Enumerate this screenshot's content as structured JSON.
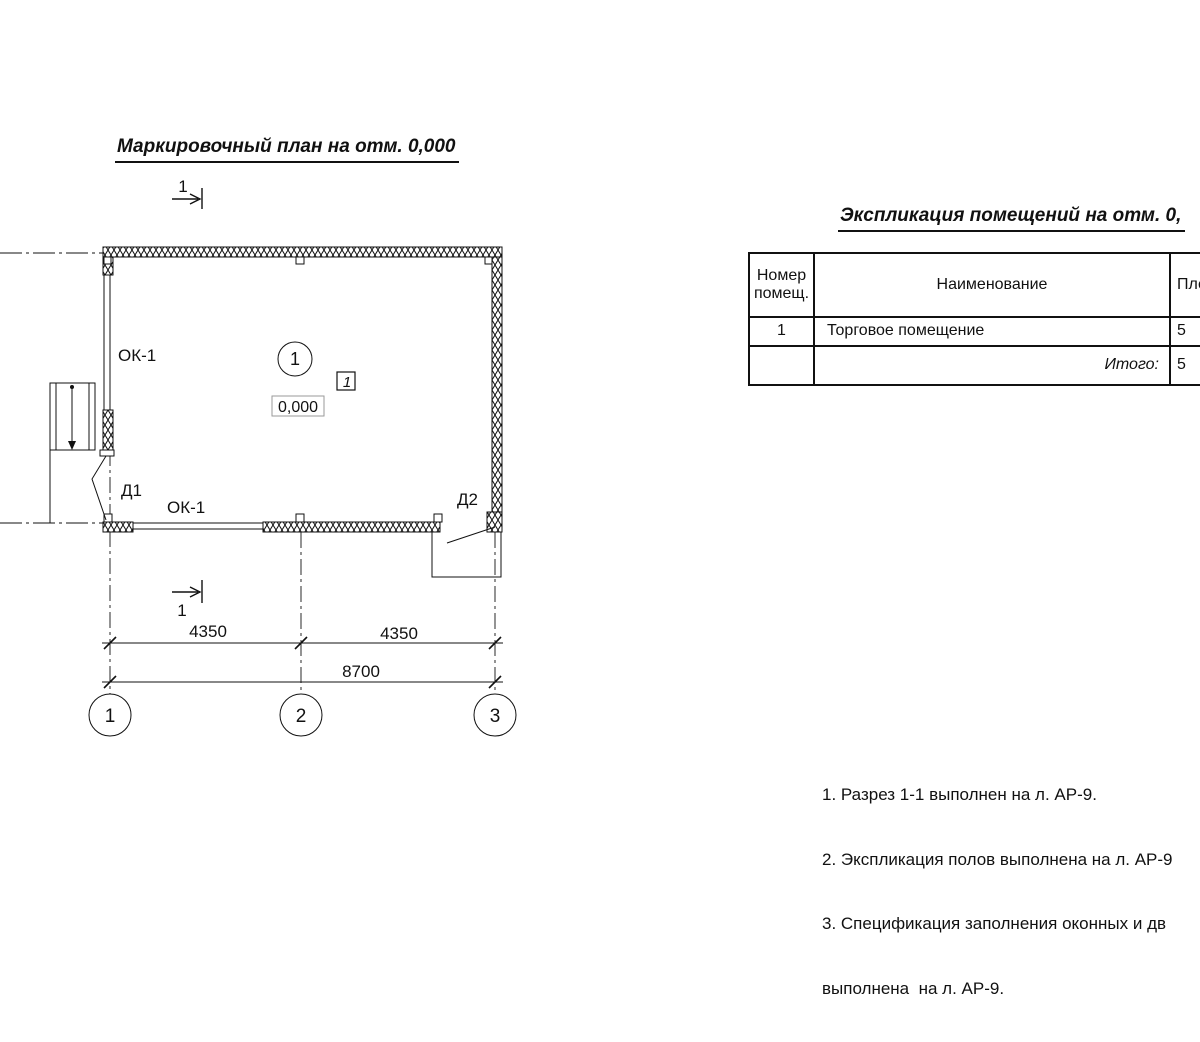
{
  "plan": {
    "title": "Маркировочный план на отм. 0,000",
    "section_mark_top": "1",
    "section_mark_bottom": "1",
    "room_number": "1",
    "room_tag": "1",
    "level_mark": "0,000",
    "window_left_label": "ОК-1",
    "window_bottom_label": "ОК-1",
    "door1_label": "Д1",
    "door2_label": "Д2",
    "dim_left": "4350",
    "dim_right": "4350",
    "dim_total": "8700",
    "axis_1": "1",
    "axis_2": "2",
    "axis_3": "3"
  },
  "explication": {
    "title": "Экспликация помещений на отм. 0,",
    "col_number": "Номер помещ.",
    "col_name": "Наименование",
    "col_area": "Пло",
    "rows": [
      {
        "number": "1",
        "name": "Торговое помещение",
        "area": "5"
      }
    ],
    "total_label": "Итого:",
    "total_area": "5"
  },
  "notes": {
    "line1": "1. Разрез 1-1 выполнен на л. АР-9.",
    "line2": "2. Экспликация полов выполнена на л. АР-9",
    "line3": "3. Спецификация заполнения оконных и дв",
    "line4": "выполнена  на л. АР-9."
  },
  "colors": {
    "ink": "#111111",
    "background": "#ffffff"
  }
}
